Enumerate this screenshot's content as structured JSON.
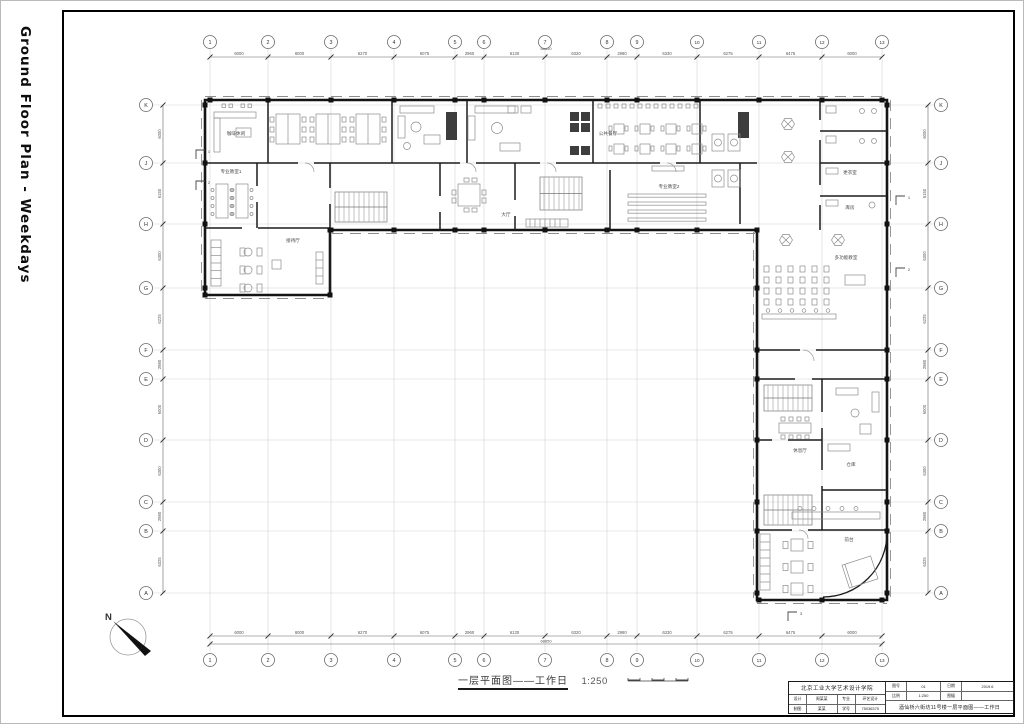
{
  "side_title": "Ground Floor Plan - Weekdays",
  "north_label": "N",
  "caption": {
    "title": "一层平面图——工作日",
    "scale": "1:250"
  },
  "grid": {
    "col_labels": [
      "1",
      "2",
      "3",
      "4",
      "5",
      "6",
      "7",
      "8",
      "9",
      "10",
      "11",
      "12",
      "13"
    ],
    "col_dims": [
      "6000",
      "6000",
      "6270",
      "6075",
      "2960",
      "6130",
      "6320",
      "2980",
      "6330",
      "6275",
      "6475",
      "6000"
    ],
    "col_total": "68850",
    "row_labels": [
      "K",
      "J",
      "H",
      "G",
      "F",
      "E",
      "D",
      "C",
      "B",
      "A"
    ],
    "row_dims": [
      "6000",
      "6150",
      "6300",
      "6225",
      "2980",
      "6000",
      "6300",
      "2980",
      "6325"
    ]
  },
  "rooms": [
    {
      "id": "coffee",
      "label": "咖啡休闲"
    },
    {
      "id": "dining",
      "label": "公共餐厅"
    },
    {
      "id": "classroom1",
      "label": "专业教室1"
    },
    {
      "id": "classroom2",
      "label": "专业教室2"
    },
    {
      "id": "hall",
      "label": "大厅"
    },
    {
      "id": "reception",
      "label": "接待厅"
    },
    {
      "id": "changing",
      "label": "更衣室"
    },
    {
      "id": "store1",
      "label": "库房"
    },
    {
      "id": "multi",
      "label": "多功能教室"
    },
    {
      "id": "lounge",
      "label": "休息厅"
    },
    {
      "id": "store2",
      "label": "仓库"
    },
    {
      "id": "frontdesk",
      "label": "前台"
    }
  ],
  "section_marks": [
    "1",
    "2",
    "1",
    "2",
    "3"
  ],
  "titleblock": {
    "school": "北京工业大学艺术设计学院",
    "info": [
      {
        "label": "图号",
        "value": "01",
        "label2": "日期",
        "value2": "2019.6"
      },
      {
        "label": "比例",
        "value": "1:250",
        "label2": "图幅",
        "value2": ""
      }
    ],
    "credits": [
      {
        "label": "设计",
        "value": "周某某",
        "label2": "专业",
        "value2": "环艺设计"
      },
      {
        "label": "制图",
        "value": "某某",
        "label2": "学号",
        "value2": "75036375"
      }
    ],
    "drawing_title": "酒仙桥六街坊11号楼一层平面图——工作日"
  }
}
